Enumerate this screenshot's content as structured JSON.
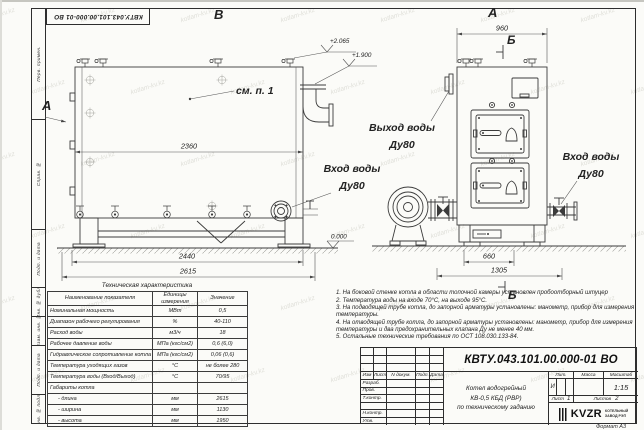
{
  "watermark": {
    "text": "kotlam-kv.kz"
  },
  "frame": {
    "doc_number_stamp": "КВТУ.043.101.00.000-01 ВО",
    "left_column": [
      "Перв. примен.",
      "Справ. №",
      "Подп. и дата",
      "Инв. № дубл.",
      "Взам. инв. №",
      "Подп. и дата",
      "Инв. № подл."
    ],
    "format_label": "Формат  А3"
  },
  "drawing": {
    "view_labels": {
      "side": "В",
      "front": "А",
      "section_top": "Б",
      "section_bottom": "Б",
      "side_arrow": "А"
    },
    "callouts": {
      "see_note": "см. п. 1",
      "outlet_l1": "Выход воды",
      "outlet_l2": "Ду80",
      "inlet_side_l1": "Вход воды",
      "inlet_side_l2": "Ду80",
      "inlet_front_l1": "Вход воды",
      "inlet_front_l2": "Ду80"
    },
    "elevations": {
      "e1": "+2.065",
      "e2": "+1.900",
      "zero": "0.000"
    },
    "dimensions": {
      "side_length": "2360",
      "side_base": "2440",
      "side_overall": "2615",
      "front_width": "960",
      "front_base": "660",
      "front_overall": "1305"
    }
  },
  "tech_table": {
    "title": "Техническая характеристика",
    "headers": [
      "Наименование показателя",
      "Единицы измерения",
      "Значение"
    ],
    "rows": [
      [
        "Номинальная мощность",
        "МВт",
        "0,5"
      ],
      [
        "Диапазон рабочего регулирования",
        "%",
        "40-110"
      ],
      [
        "Расход воды",
        "м3/ч",
        "18"
      ],
      [
        "Рабочее давление воды",
        "МПа (кгс/см2)",
        "0,6 (6,0)"
      ],
      [
        "Гидравлическое сопротивление котла",
        "МПа (кгс/см2)",
        "0,06 (0,6)"
      ],
      [
        "Температура уходящих газов",
        "°С",
        "не более 280"
      ],
      [
        "Температура воды (Вход/Выход)",
        "°С",
        "70/95"
      ],
      [
        "Габариты котла",
        "",
        ""
      ],
      [
        "- длина",
        "мм",
        "2615"
      ],
      [
        "- ширина",
        "мм",
        "1130"
      ],
      [
        "- высота",
        "мм",
        "1950"
      ]
    ]
  },
  "notes": {
    "items": [
      "1. На боковой стенке котла в области топочной камеры установлен пробоотборный штуцер",
      "2. Температура воды на входе 70°С, на выходе 95°С.",
      "3. На подводящей трубе котла, до запорной арматуры установлены: манометр, прибор для измерения температуры.",
      "4. На отводящей трубе котла, до запорной арматуры установлены: манометр, прибор для измерения температуры и два предохранительных клапана Ду не менее 40 мм.",
      "5. Остальные технические требования по ОСТ 108.030.133-84."
    ]
  },
  "title_block": {
    "doc_number": "КВТУ.043.101.00.000-01  ВО",
    "name_line1": "Котел водогрейный",
    "name_line2": "КВ-0,5 КБД (РВР)",
    "name_line3": "по техническому заданию",
    "h_izm": "Изм",
    "h_list": "Лист",
    "h_doc": "N докум.",
    "h_podp": "Подп.",
    "h_data": "Дата",
    "r1": "Разраб.",
    "r2": "Пров.",
    "r3": "Т.контр.",
    "r4": "",
    "r5": "Н.контр.",
    "r6": "Утв.",
    "lit_h": "Лит.",
    "mass_h": "Масса",
    "scale_h": "Масштаб",
    "lit_v": "И",
    "scale_v": "1:15",
    "sheet_h": "Лист",
    "sheet_v": "1",
    "sheets_h": "Листов",
    "sheets_v": "2",
    "logo": "KVZR",
    "logo_s1": "КОТЕЛЬНЫЙ",
    "logo_s2": "ЗАВОД РЭП"
  }
}
